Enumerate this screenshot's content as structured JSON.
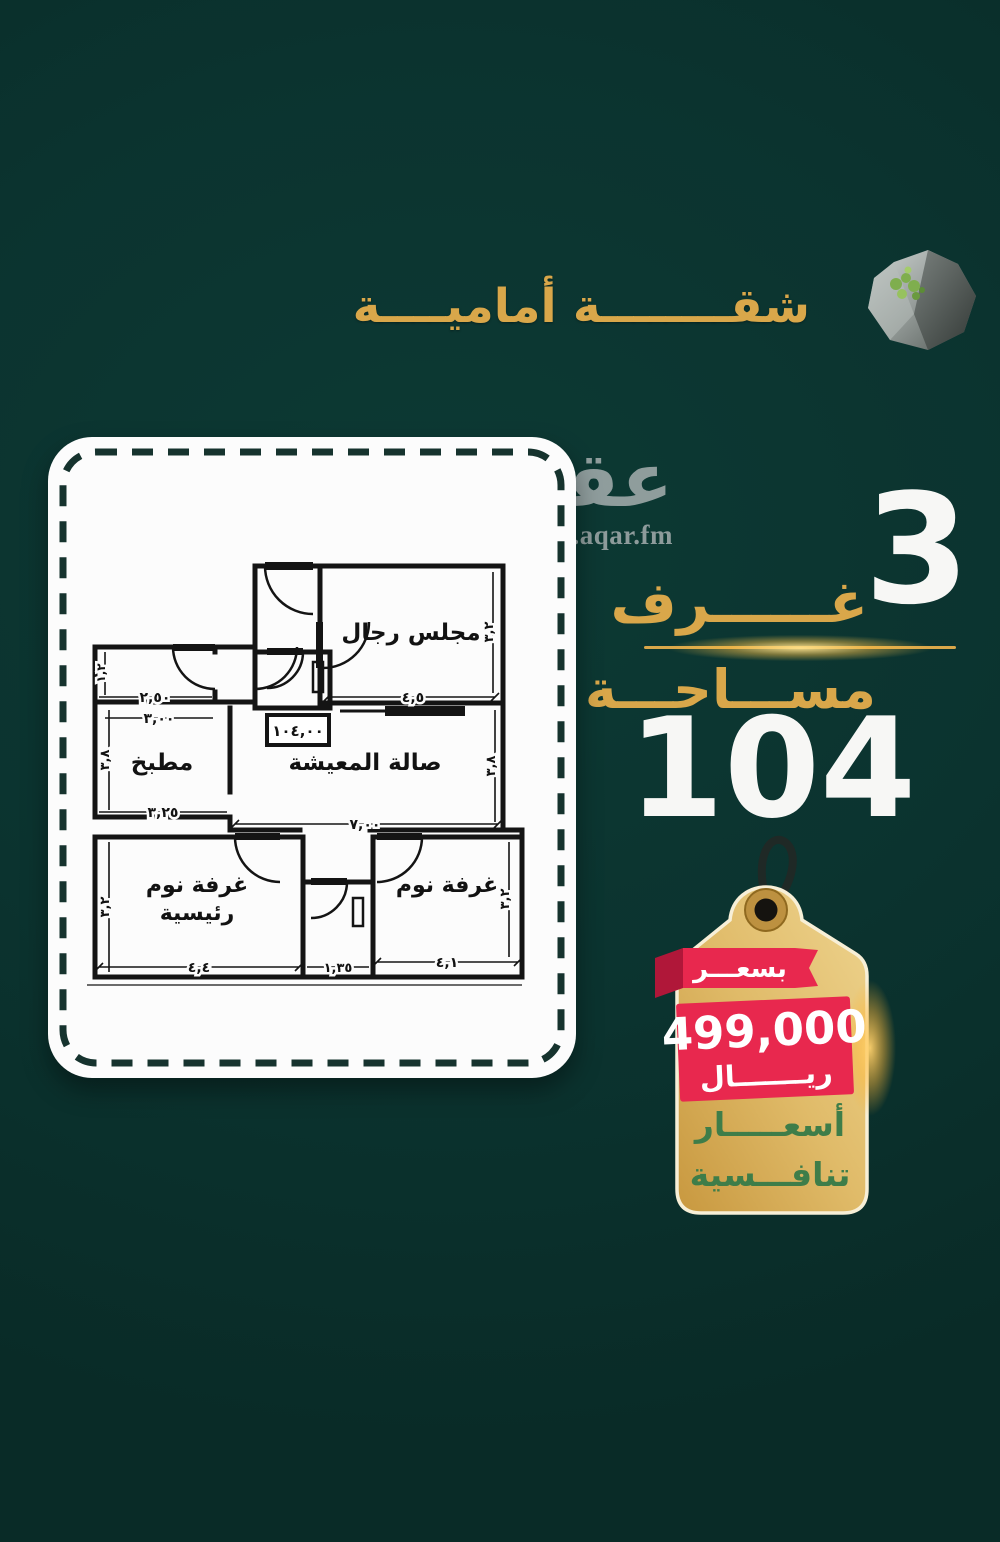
{
  "poster": {
    "background_color": "#0b332f",
    "accent_gold": "#d9a74a",
    "title": "شقــــــــة أماميــــة"
  },
  "watermark": {
    "brand": "عقار",
    "domain": "sa.aqar.fm"
  },
  "floorplan": {
    "rooms": {
      "majlis": "مجلس رجال",
      "living": "صالة المعيشة",
      "kitchen": "مطبخ",
      "master_line1": "غرفة نوم",
      "master_line2": "رئيسية",
      "bedroom": "غرفة نوم"
    },
    "area_box": "١٠٤,٠٠",
    "dims": {
      "majlis_width": "٤,٥",
      "majlis_height": "٣,٢",
      "living_width": "٧,٠٠",
      "living_height": "٣,٨",
      "kitchen_top": "٣,٠٠",
      "kitchen_bottom": "٣,٢٥",
      "kitchen_height": "٣,٨",
      "service_room_width": "٢,٥٠",
      "service_room_height": "١,٢",
      "master_width": "٤,٤",
      "master_height": "٣,٢",
      "wc_width": "١,٣٥",
      "bedroom_width": "٤,١",
      "bedroom_height": "٣,٢"
    }
  },
  "details": {
    "rooms_count": "3",
    "rooms_label": "غــــــرف",
    "area_label": "مســـاحـــة",
    "area_value": "104"
  },
  "price_tag": {
    "ribbon": "بسعـــر",
    "price": "499,000",
    "currency": "ريـــــــال",
    "note_line1": "أسعـــــار",
    "note_line2": "تنافـــسية",
    "tag_gold": "#ddaf5e",
    "ribbon_red": "#e8284e",
    "note_green": "#3e7d49"
  }
}
